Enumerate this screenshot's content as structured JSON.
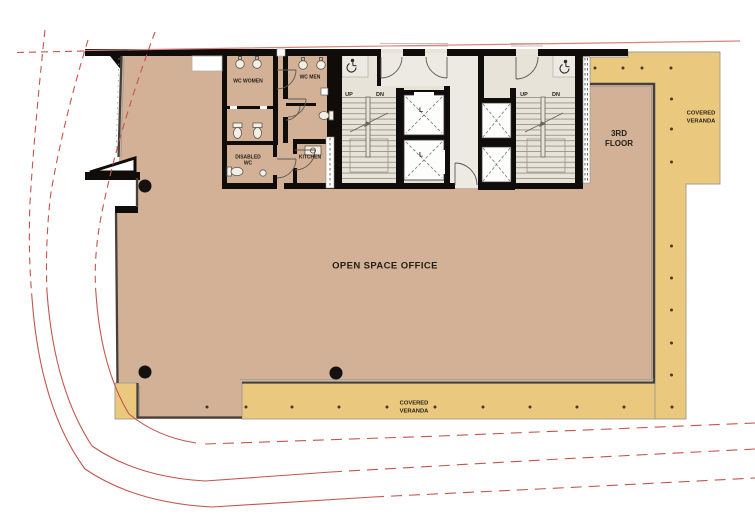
{
  "labels": {
    "open_space_office": "OPEN SPACE OFFICE",
    "floor_l1": "3RD",
    "floor_l2": "FLOOR",
    "covered_l1": "COVERED",
    "covered_l2": "VERANDA",
    "wc_women": "WC WOMEN",
    "wc_men": "WC MEN",
    "disabled_l1": "DISABLED",
    "disabled_l2": "WC",
    "kitchen": "KITCHEN",
    "up": "UP",
    "dn": "DN",
    "lift": "L"
  },
  "colors": {
    "office_floor": "#d3b197",
    "veranda_floor": "#eac97f",
    "core_floor": "#e7e3d9",
    "lobby_floor": "#edeae3",
    "wall_black": "#0f0c09",
    "boundary_red": "#c4554e",
    "boundary_red_pale": "#d8837c",
    "text_dark": "#241e15"
  }
}
